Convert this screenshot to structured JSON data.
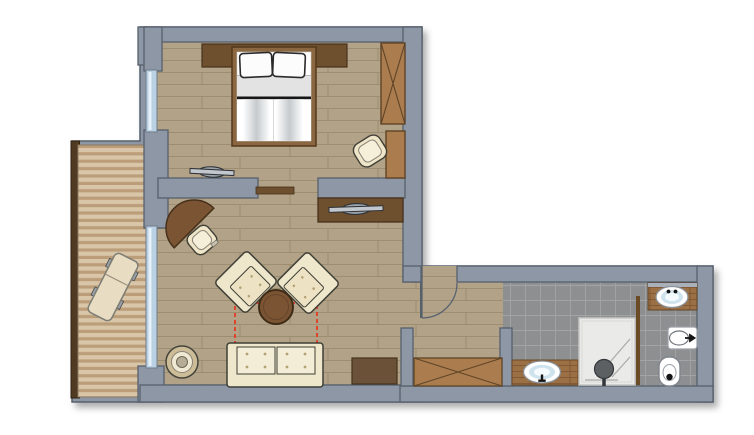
{
  "plan": {
    "type": "hotel-room-floor-plan",
    "rooms": [
      {
        "name": "bedroom",
        "furniture": [
          "double-bed",
          "pillows",
          "headboard-panel",
          "wardrobe",
          "tall-cabinet",
          "tub-armchair",
          "flat-tv"
        ]
      },
      {
        "name": "living-room",
        "furniture": [
          "corner-desk",
          "desk-chair",
          "armchair-left",
          "armchair-right",
          "round-coffee-table",
          "sofa-bed",
          "sofa-bed-pullout-outline",
          "round-side-table",
          "tv-sideboard",
          "flat-tv",
          "storage-cabinet",
          "sliding-door"
        ]
      },
      {
        "name": "balcony",
        "furniture": [
          "wood-deck",
          "railing",
          "sun-lounger"
        ]
      },
      {
        "name": "hallway",
        "furniture": [
          "entrance-door",
          "built-in-wardrobe"
        ]
      },
      {
        "name": "bathroom",
        "furniture": [
          "vanity-counter",
          "washbasin",
          "shower",
          "partition-post"
        ]
      },
      {
        "name": "wc-area",
        "furniture": [
          "vanity-counter",
          "washbasin",
          "bidet",
          "toilet"
        ]
      }
    ],
    "colors": {
      "wall": "#8d97a6",
      "wall_outline": "#57606d",
      "floor_wood": "#b2a287",
      "floor_wood_line": "#9a8b6f",
      "floor_tile": "#8e8f91",
      "floor_tile_line": "#a2a4a6",
      "deck_light": "#d9c6a8",
      "deck_dark": "#bb9d79",
      "railing": "#503a22",
      "furniture_brown": "#7b5434",
      "furniture_dark_brown": "#6e4f2e",
      "wardrobe_brown": "#aa7c4e",
      "counter_wood": "#9c7045",
      "upholstery_cream": "#efe7cc",
      "upholstery_inner": "#f3ecd6",
      "button_dot": "#b3a274",
      "window_glass": "#bad1e4",
      "pullout_dashed": "#e23b25",
      "fixture_white": "#ffffff",
      "basin_blue": "#cfe3ef",
      "shower_gray": "#eaeae8",
      "tv_gray": "#9aa2aa"
    }
  }
}
